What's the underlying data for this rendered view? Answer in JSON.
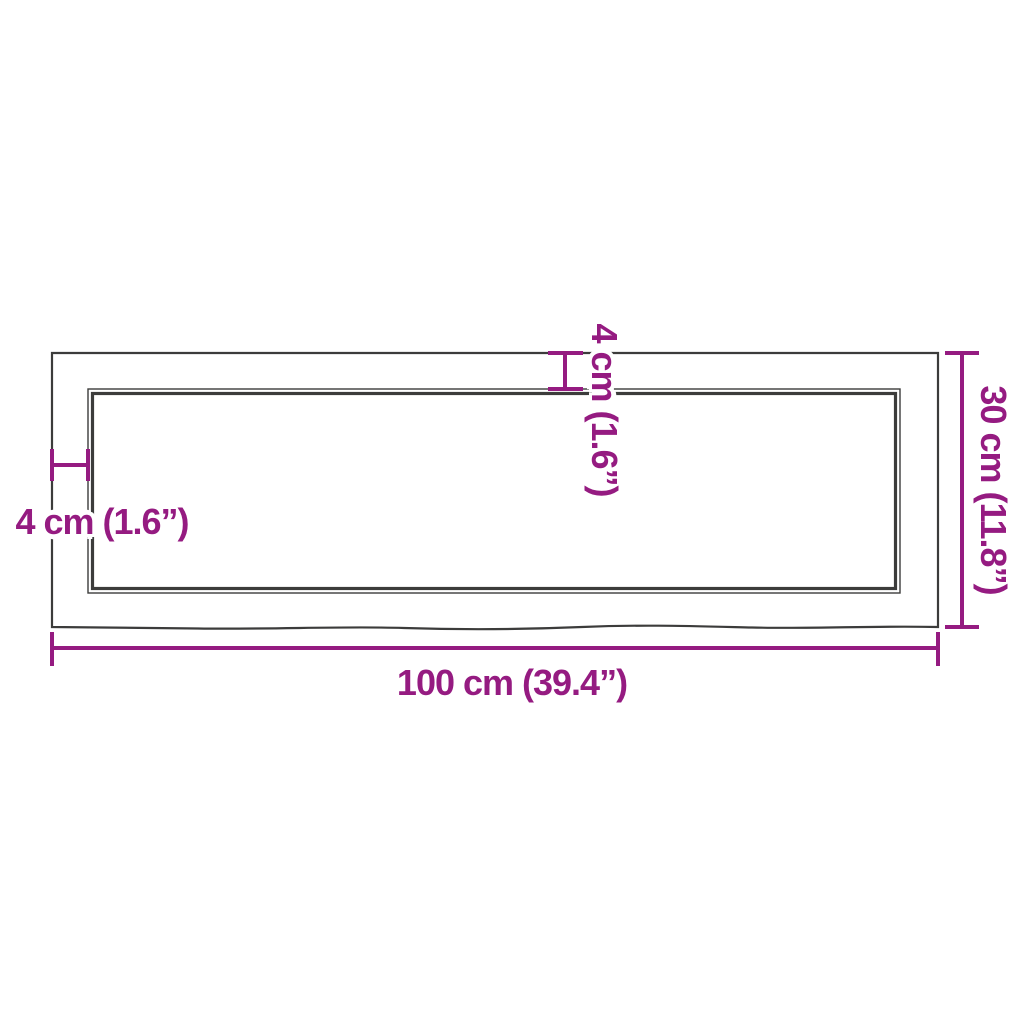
{
  "diagram": {
    "type": "product-dimension-diagram",
    "subject": "rectangular wooden board / table top with live bottom edge, top view",
    "colors": {
      "dimension_accent": "#951b81",
      "board_outline": "#3c3c3b",
      "background": "#ffffff"
    },
    "labels": {
      "width_bottom": "100 cm (39.4”)",
      "height_right": "30 cm (11.8”)",
      "thickness_left": "4 cm (1.6”)",
      "thickness_top": "4 cm (1.6”)"
    },
    "values": {
      "width_cm": 100,
      "width_in": 39.4,
      "height_cm": 30,
      "height_in": 11.8,
      "thickness_cm": 4,
      "thickness_in": 1.6
    }
  }
}
